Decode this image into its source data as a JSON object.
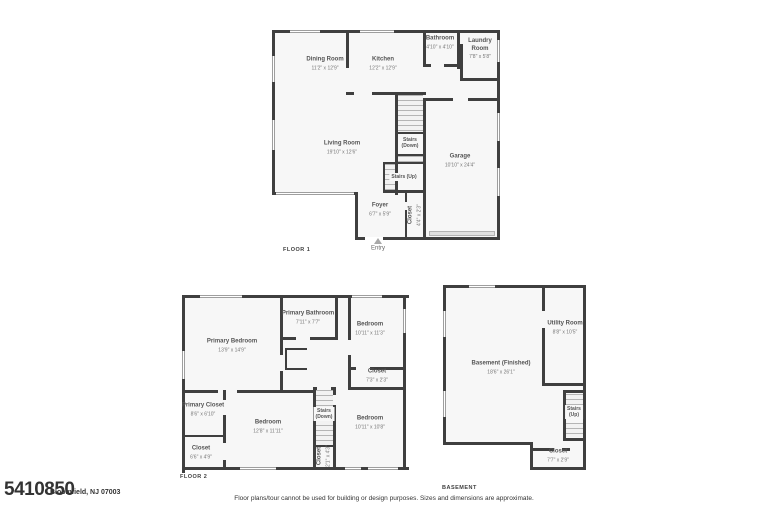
{
  "listing": {
    "id": "5410850",
    "address": "Bloomfield, NJ 07003"
  },
  "disclaimer": "Floor plans/tour cannot be used for building or design purposes. Sizes and dimensions are approximate.",
  "floor1": {
    "title": "FLOOR 1",
    "rooms": {
      "dining": {
        "name": "Dining Room",
        "dims": "11'2\" x 12'9\""
      },
      "kitchen": {
        "name": "Kitchen",
        "dims": "12'2\" x 12'9\""
      },
      "bathroom": {
        "name": "Bathroom",
        "dims": "4'10\" x 4'10\""
      },
      "laundry": {
        "name": "Laundry Room",
        "dims": "7'8\" x 5'8\""
      },
      "living": {
        "name": "Living Room",
        "dims": "19'10\" x 12'6\""
      },
      "garage": {
        "name": "Garage",
        "dims": "10'10\" x 24'4\""
      },
      "foyer": {
        "name": "Foyer",
        "dims": "6'7\" x 5'9\""
      },
      "closet": {
        "name": "Closet",
        "dims": "4'4\" x 2'3\""
      },
      "stairs_down": {
        "line1": "Stairs",
        "line2": "(Down)"
      },
      "stairs_up": {
        "line1": "Stairs (Up)"
      },
      "entry": {
        "name": "Entry"
      }
    }
  },
  "floor2": {
    "title": "FLOOR 2",
    "rooms": {
      "primary_bedroom": {
        "name": "Primary Bedroom",
        "dims": "13'9\" x 14'9\""
      },
      "primary_bathroom": {
        "name": "Primary Bathroom",
        "dims": "7'11\" x 7'7\""
      },
      "bedroom_top": {
        "name": "Bedroom",
        "dims": "10'11\" x 11'3\""
      },
      "closet_right": {
        "name": "Closet",
        "dims": "7'3\" x 2'3\""
      },
      "primary_closet": {
        "name": "Primary Closet",
        "dims": "8'6\" x 6'10\""
      },
      "closet_left": {
        "name": "Closet",
        "dims": "6'6\" x 4'9\""
      },
      "bedroom_mid": {
        "name": "Bedroom",
        "dims": "12'8\" x 11'11\""
      },
      "bedroom_right": {
        "name": "Bedroom",
        "dims": "10'11\" x 10'8\""
      },
      "stairs_down": {
        "line1": "Stairs",
        "line2": "(Down)"
      },
      "closet_stairs": {
        "name": "Closet",
        "dims": "2'1\" x 4'3\""
      }
    }
  },
  "basement": {
    "title": "BASEMENT",
    "rooms": {
      "utility": {
        "name": "Utility Room",
        "dims": "8'8\" x 10'5\""
      },
      "finished": {
        "name": "Basement (Finished)",
        "dims": "18'6\" x 26'1\""
      },
      "stairs_up": {
        "line1": "Stairs",
        "line2": "(Up)"
      },
      "closet": {
        "name": "Closet",
        "dims": "7'7\" x 2'9\""
      }
    }
  }
}
